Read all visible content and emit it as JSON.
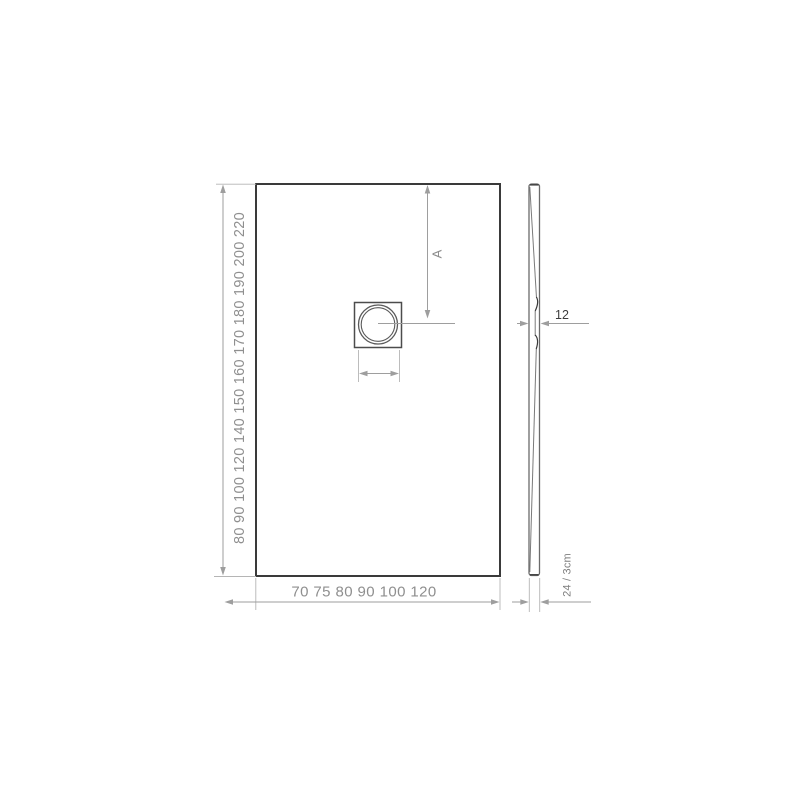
{
  "plan_view": {
    "length_scale_labels": "80 90 100 120 140 150 160 170 180 190 200 220",
    "width_scale_labels": "70 75 80 90 100 120",
    "drain_position_label": "A"
  },
  "side_view": {
    "center_thickness_label": "12",
    "edge_thickness_label": "24 / 3cm"
  },
  "colors": {
    "outline": "#3a3a3a",
    "dim": "#9e9e9e",
    "label": "#8f8f8f",
    "darklabel": "#3c3c3c",
    "profile": "#6b6b6b",
    "bg": "#ffffff"
  }
}
